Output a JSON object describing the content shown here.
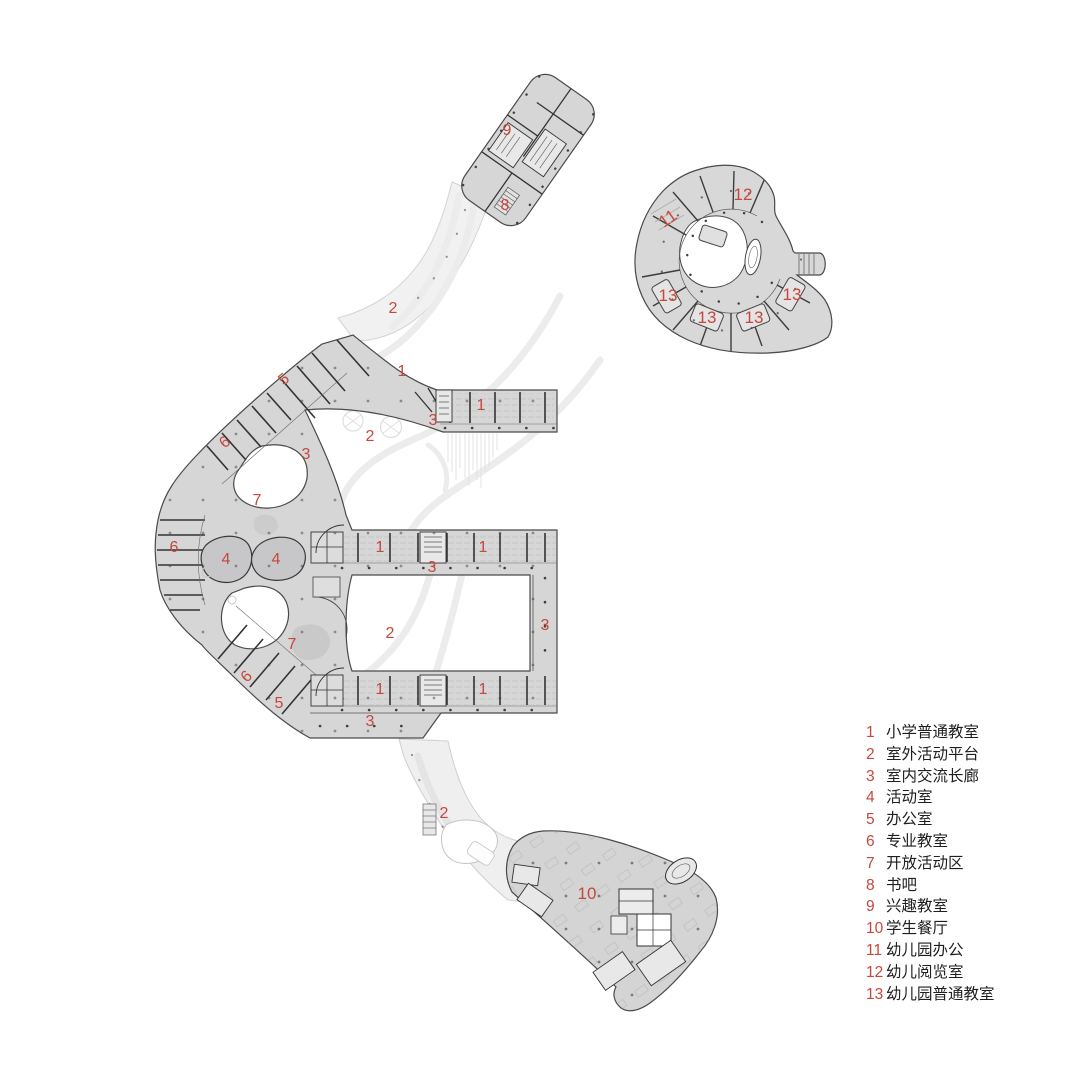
{
  "title": "学校一层总平面图",
  "colors": {
    "label_red": "#c5483c",
    "building_fill": "#d6d6d7",
    "building_stroke": "#4a4a4a",
    "wall_dark": "#333333",
    "ground_fill": "#f0f0f0",
    "ground_stroke": "#d0d0d0",
    "courtyard_white": "#ffffff"
  },
  "legend": {
    "items": [
      {
        "num": "1",
        "label": "小学普通教室"
      },
      {
        "num": "2",
        "label": "室外活动平台"
      },
      {
        "num": "3",
        "label": "室内交流长廊"
      },
      {
        "num": "4",
        "label": "活动室"
      },
      {
        "num": "5",
        "label": "办公室"
      },
      {
        "num": "6",
        "label": "专业教室"
      },
      {
        "num": "7",
        "label": "开放活动区"
      },
      {
        "num": "8",
        "label": "书吧"
      },
      {
        "num": "9",
        "label": "兴趣教室"
      },
      {
        "num": "10",
        "label": "学生餐厅"
      },
      {
        "num": "11",
        "label": "幼儿园办公"
      },
      {
        "num": "12",
        "label": "幼儿阅览室"
      },
      {
        "num": "13",
        "label": "幼儿园普通教室"
      }
    ]
  },
  "plan_labels": [
    {
      "num": "9",
      "x": 507,
      "y": 135
    },
    {
      "num": "8",
      "x": 505,
      "y": 210
    },
    {
      "num": "12",
      "x": 743,
      "y": 200
    },
    {
      "num": "11",
      "x": 671,
      "y": 223,
      "r": -35
    },
    {
      "num": "13",
      "x": 668,
      "y": 301
    },
    {
      "num": "13",
      "x": 707,
      "y": 323
    },
    {
      "num": "13",
      "x": 754,
      "y": 323
    },
    {
      "num": "13",
      "x": 792,
      "y": 300
    },
    {
      "num": "2",
      "x": 393,
      "y": 313
    },
    {
      "num": "5",
      "x": 287,
      "y": 383,
      "r": -40
    },
    {
      "num": "1",
      "x": 402,
      "y": 376
    },
    {
      "num": "1",
      "x": 481,
      "y": 410
    },
    {
      "num": "3",
      "x": 433,
      "y": 425
    },
    {
      "num": "2",
      "x": 370,
      "y": 441
    },
    {
      "num": "6",
      "x": 228,
      "y": 446,
      "r": -40
    },
    {
      "num": "3",
      "x": 306,
      "y": 459
    },
    {
      "num": "7",
      "x": 257,
      "y": 505
    },
    {
      "num": "6",
      "x": 174,
      "y": 552
    },
    {
      "num": "4",
      "x": 226,
      "y": 564
    },
    {
      "num": "4",
      "x": 276,
      "y": 564
    },
    {
      "num": "1",
      "x": 380,
      "y": 552
    },
    {
      "num": "1",
      "x": 483,
      "y": 552
    },
    {
      "num": "3",
      "x": 432,
      "y": 572
    },
    {
      "num": "2",
      "x": 390,
      "y": 638
    },
    {
      "num": "3",
      "x": 545,
      "y": 630
    },
    {
      "num": "7",
      "x": 292,
      "y": 649
    },
    {
      "num": "6",
      "x": 250,
      "y": 680,
      "r": -45
    },
    {
      "num": "5",
      "x": 279,
      "y": 708
    },
    {
      "num": "1",
      "x": 380,
      "y": 694
    },
    {
      "num": "1",
      "x": 483,
      "y": 694
    },
    {
      "num": "3",
      "x": 370,
      "y": 726
    },
    {
      "num": "2",
      "x": 444,
      "y": 818
    },
    {
      "num": "10",
      "x": 587,
      "y": 899
    }
  ]
}
